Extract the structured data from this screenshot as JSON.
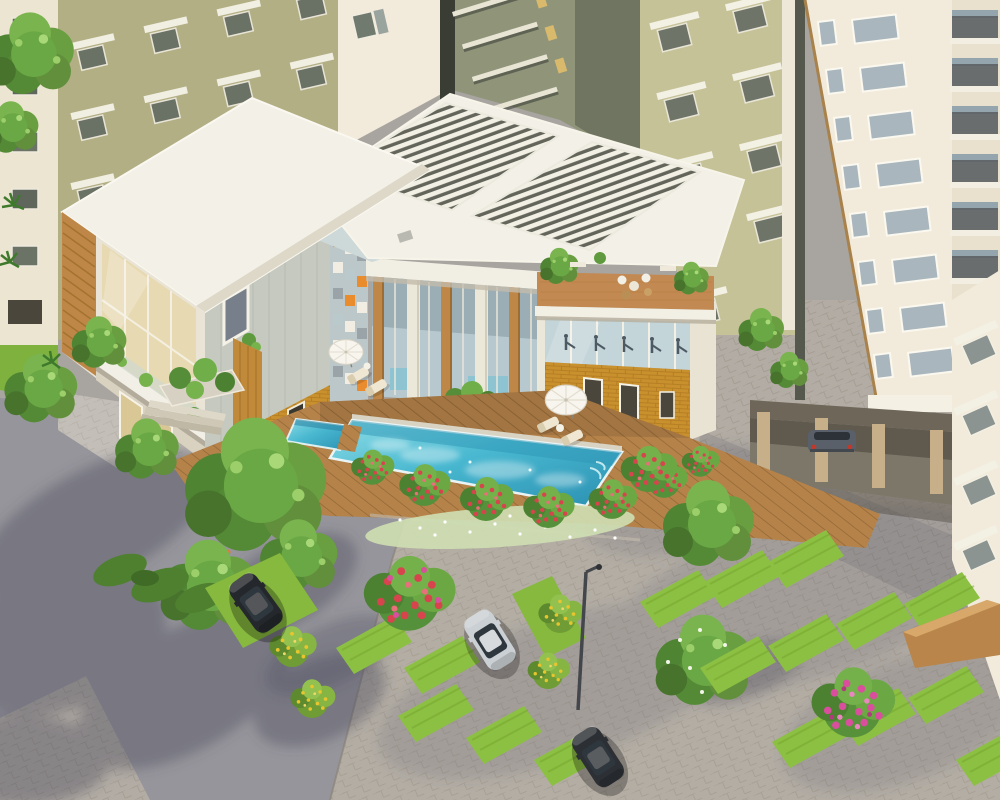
{
  "meta": {
    "title": "Aerial 3D architectural rendering of a residential complex clubhouse with swimming pool, landscaped parking and apartment towers",
    "view": "aerial perspective",
    "visible_text": []
  },
  "palette": {
    "olive_facade": "#b2af85",
    "olive_light": "#c5c298",
    "cream_facade": "#f2ebdb",
    "sliver_cream": "#ece5d1",
    "recessed_facade": "#90957a",
    "clubhouse_white": "#f3f0e7",
    "clubhouse_gray": "#c6c9bf",
    "wood_accent": "#bf8747",
    "ochre_band": "#c9902e",
    "glass_blue": "#c4d5d9",
    "beige_glass": "#e7dab2",
    "pool_water": "#49b8d0",
    "deck_wood": "#b5834a",
    "terrace_floor": "#c28a52",
    "asphalt": "#96959b",
    "pavers": "#b2aca4",
    "grass": "#8cc043",
    "foliage": "#5f9a3e",
    "flower_red": "#d8444e",
    "flower_pink": "#d94f9e",
    "flower_yellow": "#e7c52f",
    "umbrella_white": "#f7f5ee",
    "car_black": "#24272b",
    "car_silver": "#cbd0d4",
    "car_dark": "#2c3034",
    "car_slate": "#596069"
  },
  "scene": {
    "buildings": [
      "apartment-sliver-left",
      "apartment-tower-olive-left",
      "apartment-block-top-center",
      "apartment-block-recessed",
      "apartment-tower-olive-right",
      "apartment-tower-cream-right",
      "apartment-wing-far-right"
    ],
    "clubhouse_features": [
      "flat-white-roof",
      "louvered-pergola-roof",
      "roof-terrace-with-plants",
      "glass-gym-facade",
      "timber-colonnade",
      "wood-slat-facade",
      "checker-glass-wall",
      "ochre-brick-base",
      "balcony-with-planters",
      "entrance-steps"
    ],
    "amenities": [
      "swimming-pool",
      "kids-pool",
      "timber-pool-deck",
      "pool-umbrellas",
      "sun-loungers",
      "terrace-seating"
    ],
    "vehicles": [
      "black-suv",
      "silver-car",
      "dark-sedan",
      "parked-car-under-building"
    ],
    "vegetation": [
      "shade-trees",
      "red-flowering-shrubs",
      "pink-bougainvillea",
      "yellow-flowering-shrubs",
      "white-flower-bed",
      "hedge-row",
      "lawn-strips"
    ],
    "hardscape": [
      "asphalt-road",
      "paver-plaza",
      "grass-paver-parking",
      "street-lamp",
      "compound-wall"
    ]
  }
}
